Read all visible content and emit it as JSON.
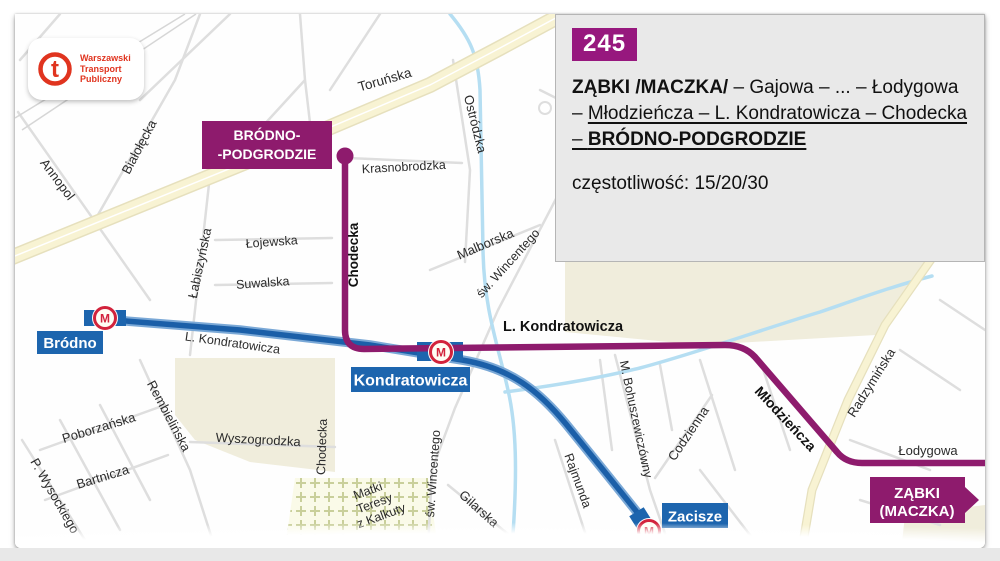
{
  "logo": {
    "glyph": "t",
    "lines": [
      "Warszawski",
      "Transport",
      "Publiczny"
    ]
  },
  "info_box": {
    "line_number": "245",
    "route": {
      "part1_bold": "ZĄBKI /MACZKA/",
      "part2": " – Gajowa – ... – Łodygowa – ",
      "part3_underlined": "Młodzieńcza – L. Kondratowicza – Chodecka – ",
      "part4_bold_underlined": "BRÓDNO-PODGRODZIE"
    },
    "frequency": "częstotliwość: 15/20/30"
  },
  "map": {
    "terminals": {
      "brodno_podgrodzie": {
        "line1": "BRÓDNO-",
        "line2": "-PODGRODZIE"
      },
      "zabki_maczka": {
        "line1": "ZĄBKI",
        "line2": "(MACZKA)"
      }
    },
    "stations": [
      {
        "name": "Bródno"
      },
      {
        "name": "Kondratowicza"
      },
      {
        "name": "Zacisze"
      }
    ],
    "metro_icon_letter": "M",
    "streets": [
      {
        "name": "Annopol"
      },
      {
        "name": "Białołęcka"
      },
      {
        "name": "Toruńska"
      },
      {
        "name": "Ostródzka"
      },
      {
        "name": "Łabiszyńska"
      },
      {
        "name": "Łojewska"
      },
      {
        "name": "Suwalska"
      },
      {
        "name": "Krasnobrodzka"
      },
      {
        "name": "Chodecka"
      },
      {
        "name": "Malborska"
      },
      {
        "name": "św. Wincentego"
      },
      {
        "name": "L. Kondratowicza"
      },
      {
        "name": "L. Kondratowicza"
      },
      {
        "name": "Młodzieńcza"
      },
      {
        "name": "Radzymińska"
      },
      {
        "name": "Łodygowa"
      },
      {
        "name": "M. Bohuszewiczówny"
      },
      {
        "name": "Codzienna"
      },
      {
        "name": "Rajmunda"
      },
      {
        "name": "Wyszogrodzka"
      },
      {
        "name": "Poborzańska"
      },
      {
        "name": "Bartnicza"
      },
      {
        "name": "P. Wysockiego"
      },
      {
        "name": "Rembielińska"
      },
      {
        "name": "Gilarska"
      },
      {
        "name": "Chodecka"
      },
      {
        "name": "św. Wincentego"
      },
      {
        "lines": [
          "Matki",
          "Teresy",
          "z Kalkuty"
        ]
      }
    ],
    "colors": {
      "route_purple": "#8e1b6d",
      "badge_purple": "#97187e",
      "metro_line_blue": "#1b5fa8",
      "station_label_blue": "#1d65ae",
      "metro_logo_red": "#d2233c",
      "major_road_yellow": "#f8f3d3",
      "stream_blue": "#b5def2",
      "park_beige": "#f0eddc",
      "logo_red": "#e0341f"
    }
  }
}
